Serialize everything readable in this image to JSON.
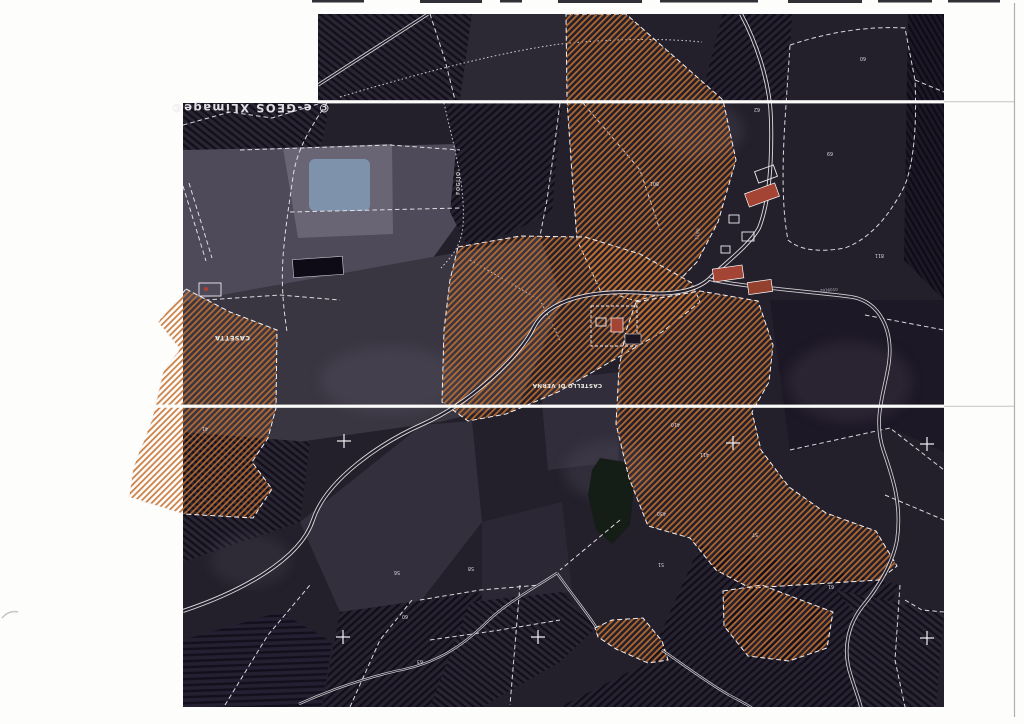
{
  "page": {
    "background": "#fdfdfc",
    "scan_edge_note": "scanned sheet edge line"
  },
  "map": {
    "watermark": {
      "text": "© e-GEOS  XLimage©"
    },
    "place_labels": [
      {
        "id": "casetta",
        "text": "CASETTA"
      },
      {
        "id": "castello",
        "text": "CASTELLO DI VERNA"
      },
      {
        "id": "foglio",
        "text": "FOGLIO"
      }
    ],
    "road_labels": [
      {
        "id": "road-code-1",
        "text": "1190"
      },
      {
        "id": "road-code-2",
        "text": "2936010"
      }
    ],
    "parcel_numbers": [
      {
        "t": "69",
        "x": 833,
        "y": 152
      },
      {
        "t": "801",
        "x": 659,
        "y": 182
      },
      {
        "t": "811",
        "x": 884,
        "y": 254
      },
      {
        "t": "62",
        "x": 760,
        "y": 108
      },
      {
        "t": "60",
        "x": 866,
        "y": 57
      },
      {
        "t": "410",
        "x": 680,
        "y": 423
      },
      {
        "t": "411",
        "x": 709,
        "y": 453
      },
      {
        "t": "430",
        "x": 666,
        "y": 512
      },
      {
        "t": "57",
        "x": 758,
        "y": 533
      },
      {
        "t": "51",
        "x": 664,
        "y": 563
      },
      {
        "t": "61",
        "x": 834,
        "y": 585
      },
      {
        "t": "56",
        "x": 400,
        "y": 571
      },
      {
        "t": "60",
        "x": 408,
        "y": 615
      },
      {
        "t": "58",
        "x": 474,
        "y": 567
      },
      {
        "t": "63",
        "x": 423,
        "y": 660
      },
      {
        "t": "41",
        "x": 208,
        "y": 427
      }
    ],
    "survey_crosses": [
      {
        "x": 344,
        "y": 441
      },
      {
        "x": 733,
        "y": 443
      },
      {
        "x": 927,
        "y": 444
      },
      {
        "x": 343,
        "y": 637
      },
      {
        "x": 538,
        "y": 637
      },
      {
        "x": 927,
        "y": 638
      }
    ],
    "colors": {
      "page_bg": "#fdfdfc",
      "photo_base": "#231f2b",
      "hatch": "#c3702f",
      "field_red": "#74514d",
      "pond": "#7e93ab",
      "lake": "#151d17",
      "line": "#e9e9ee",
      "roof": "#a34434",
      "road_dark": "#241f2b",
      "road_edge": "#f0f0f2"
    }
  }
}
